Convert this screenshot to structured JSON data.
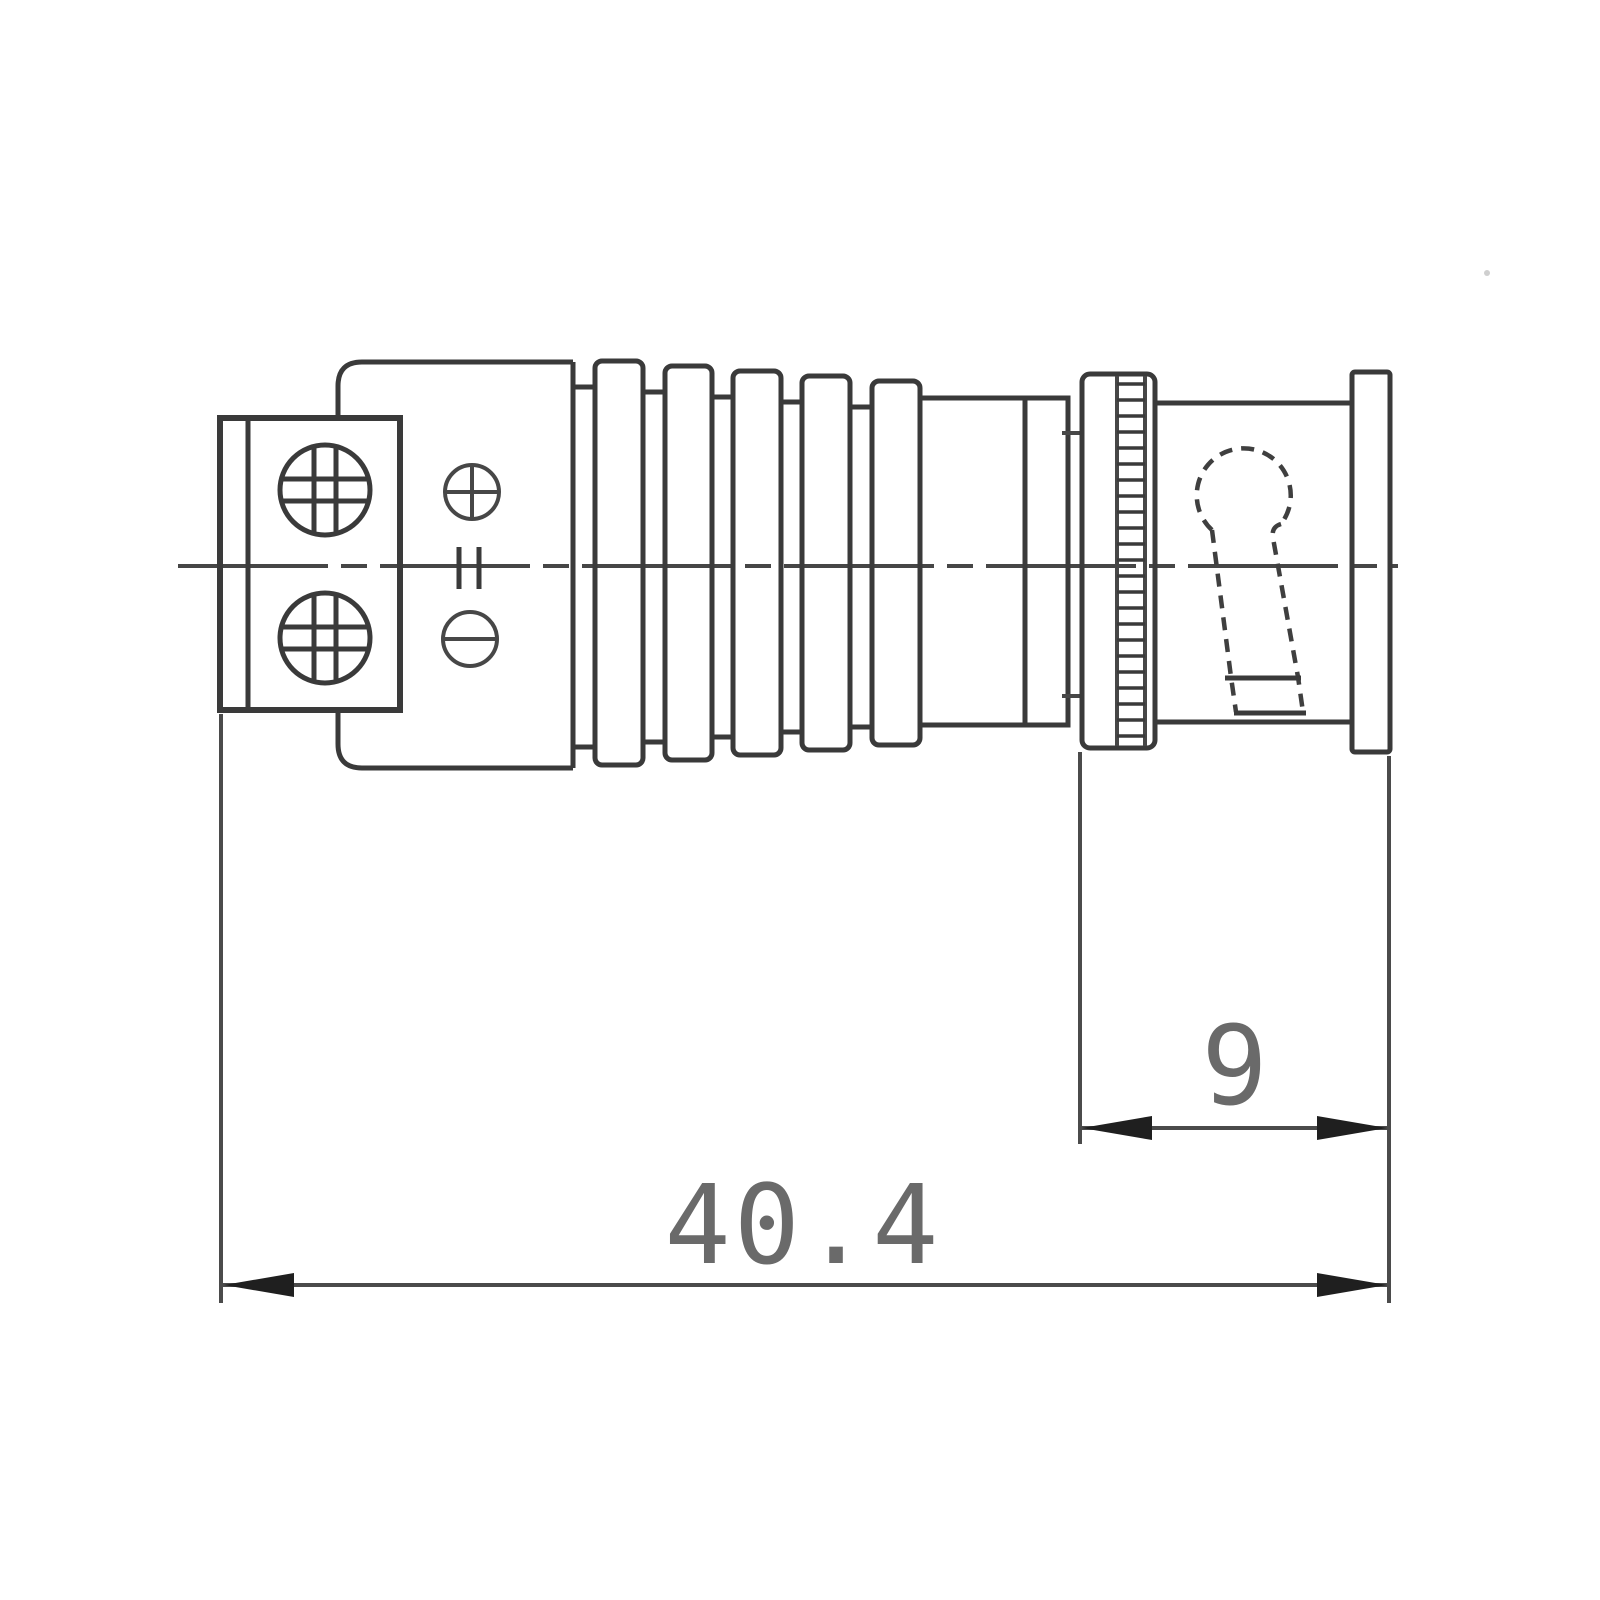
{
  "page": {
    "background_color": "#ffffff"
  },
  "drawing": {
    "stroke_color": "#3a3a3a",
    "dimension_line_color": "#4b4b4b",
    "dimension_text_color": "#6a6a6a",
    "dimensions": {
      "overall_length": {
        "value": "40.4"
      },
      "front_section_length": {
        "value": "9"
      }
    },
    "symbols": {
      "positive_terminal": "circle-plus-icon",
      "negative_terminal": "circle-minus-icon",
      "screw_heads": "phillips-cross-icon",
      "bayonet_slot": "hidden-dashed-keyhole",
      "centerline_style": "dash-dot"
    }
  }
}
